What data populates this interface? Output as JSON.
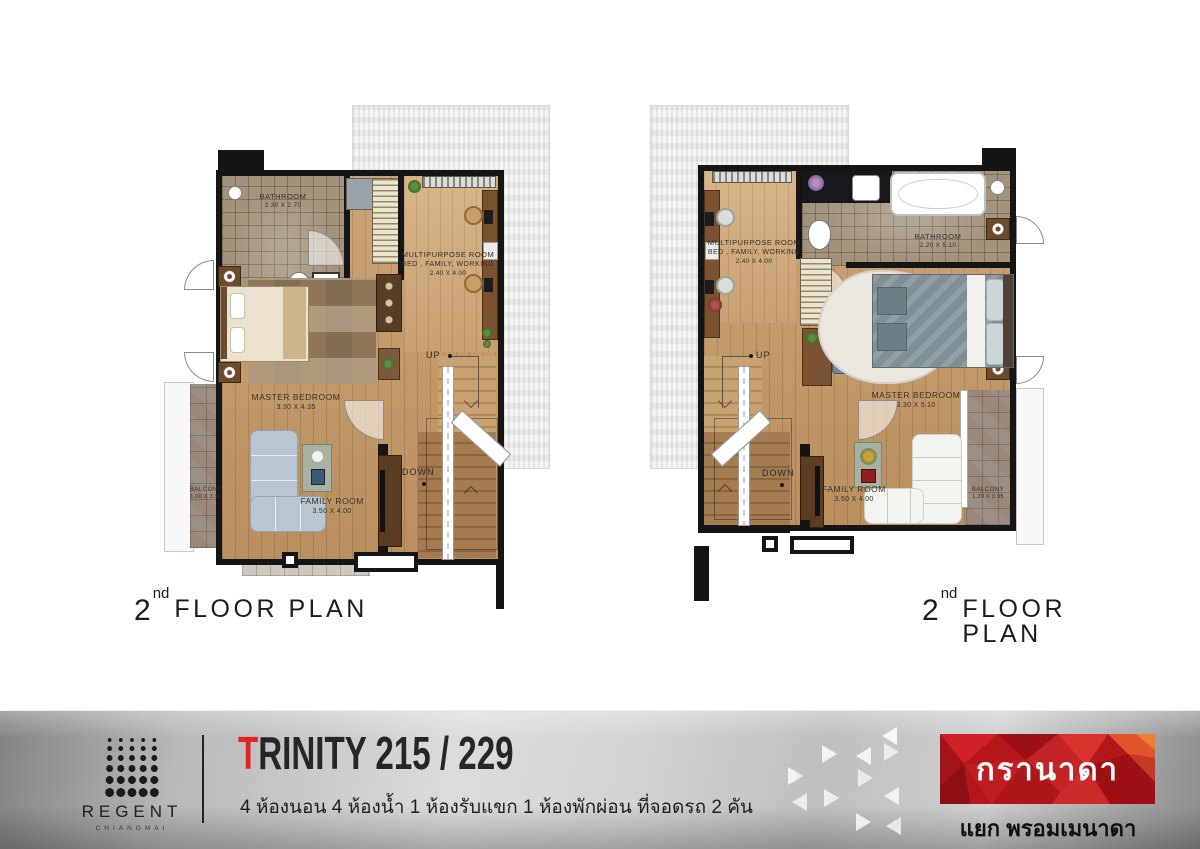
{
  "palette": {
    "accent_red": "#e32227",
    "granada_red": "#b5161b",
    "wall_black": "#151515",
    "wood_floor": "#c79a66",
    "wood_floor_light": "#d3aa78",
    "bath_tile": "#a3927c",
    "balcony_tile": "#9d8e84",
    "roof_gray": "#e9e9e7",
    "footer_gray_light": "#dcdcdc",
    "footer_gray_dark": "#828282"
  },
  "plans": {
    "left": {
      "floor_label": {
        "number": "2",
        "ordinal": "nd",
        "text": "FLOOR PLAN"
      },
      "rooms": {
        "bathroom": {
          "name": "BATHROOM",
          "dims": "2.30 X 2.70"
        },
        "multipurpose": {
          "name": "MULTIPURPOSE ROOM",
          "subtitle": "BED , FAMILY, WORKING",
          "dims": "2.40 X 4.00"
        },
        "master_bedroom": {
          "name": "MASTER BEDROOM",
          "dims": "3.30 X 4.35"
        },
        "family_room": {
          "name": "FAMILY ROOM",
          "dims": "3.50 X 4.00"
        },
        "balcony": {
          "name": "BALCONY",
          "dims": "1.00 X 3.95"
        }
      },
      "stairs": {
        "up": "UP",
        "down": "DOWN"
      }
    },
    "right": {
      "floor_label": {
        "number": "2",
        "ordinal": "nd",
        "text": "FLOOR PLAN"
      },
      "rooms": {
        "bathroom": {
          "name": "BATHROOM",
          "dims": "2.20 X 5.10"
        },
        "multipurpose": {
          "name": "MULTIPURPOSE ROOM",
          "subtitle": "BED , FAMILY, WORKING",
          "dims": "2.40 X 4.00"
        },
        "master_bedroom": {
          "name": "MASTER BEDROOM",
          "dims": "3.30 X 5.10"
        },
        "family_room": {
          "name": "FAMILY ROOM",
          "dims": "3.50 X 4.00"
        },
        "balcony": {
          "name": "BALCONY",
          "dims": "1.20 X 3.95"
        }
      },
      "stairs": {
        "up": "UP",
        "down": "DOWN"
      }
    }
  },
  "footer": {
    "regent": {
      "name": "REGENT",
      "city": "CHIANGMAI"
    },
    "title": {
      "first_letter": "T",
      "rest": "RINITY 215 / 229"
    },
    "subtitle_th": "4 ห้องนอน 4 ห้องน้ำ 1 ห้องรับแขก 1 ห้องพักผ่อน ที่จอดรถ 2 คัน",
    "granada": {
      "brand_th": "กรานาดา",
      "location_th": "แยก พรอมเมนาดา"
    }
  }
}
